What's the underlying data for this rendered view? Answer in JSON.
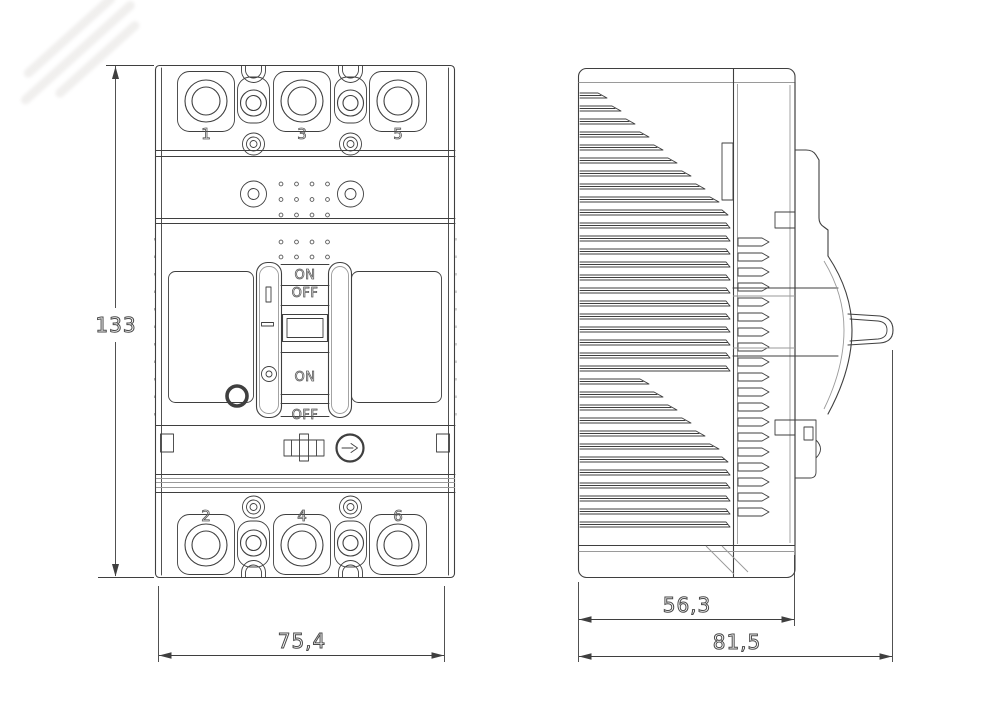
{
  "colors": {
    "background": "#ffffff",
    "line": "#3f3f3f",
    "light_line": "#9a9a9a",
    "text": "#4a4a4a"
  },
  "front_view": {
    "top_terminals": [
      "1",
      "3",
      "5"
    ],
    "bottom_terminals": [
      "2",
      "4",
      "6"
    ],
    "toggle": {
      "on_upper": "ON",
      "off_upper": "OFF",
      "on_lower": "ON",
      "off_lower": "OFF"
    },
    "icons": [
      "direction-arrow-icon",
      "test-button-icon",
      "slider-latch-icon"
    ]
  },
  "dimensions": {
    "height": "133",
    "width": "75,4",
    "body_depth": "56,3",
    "overall_depth": "81,5"
  }
}
